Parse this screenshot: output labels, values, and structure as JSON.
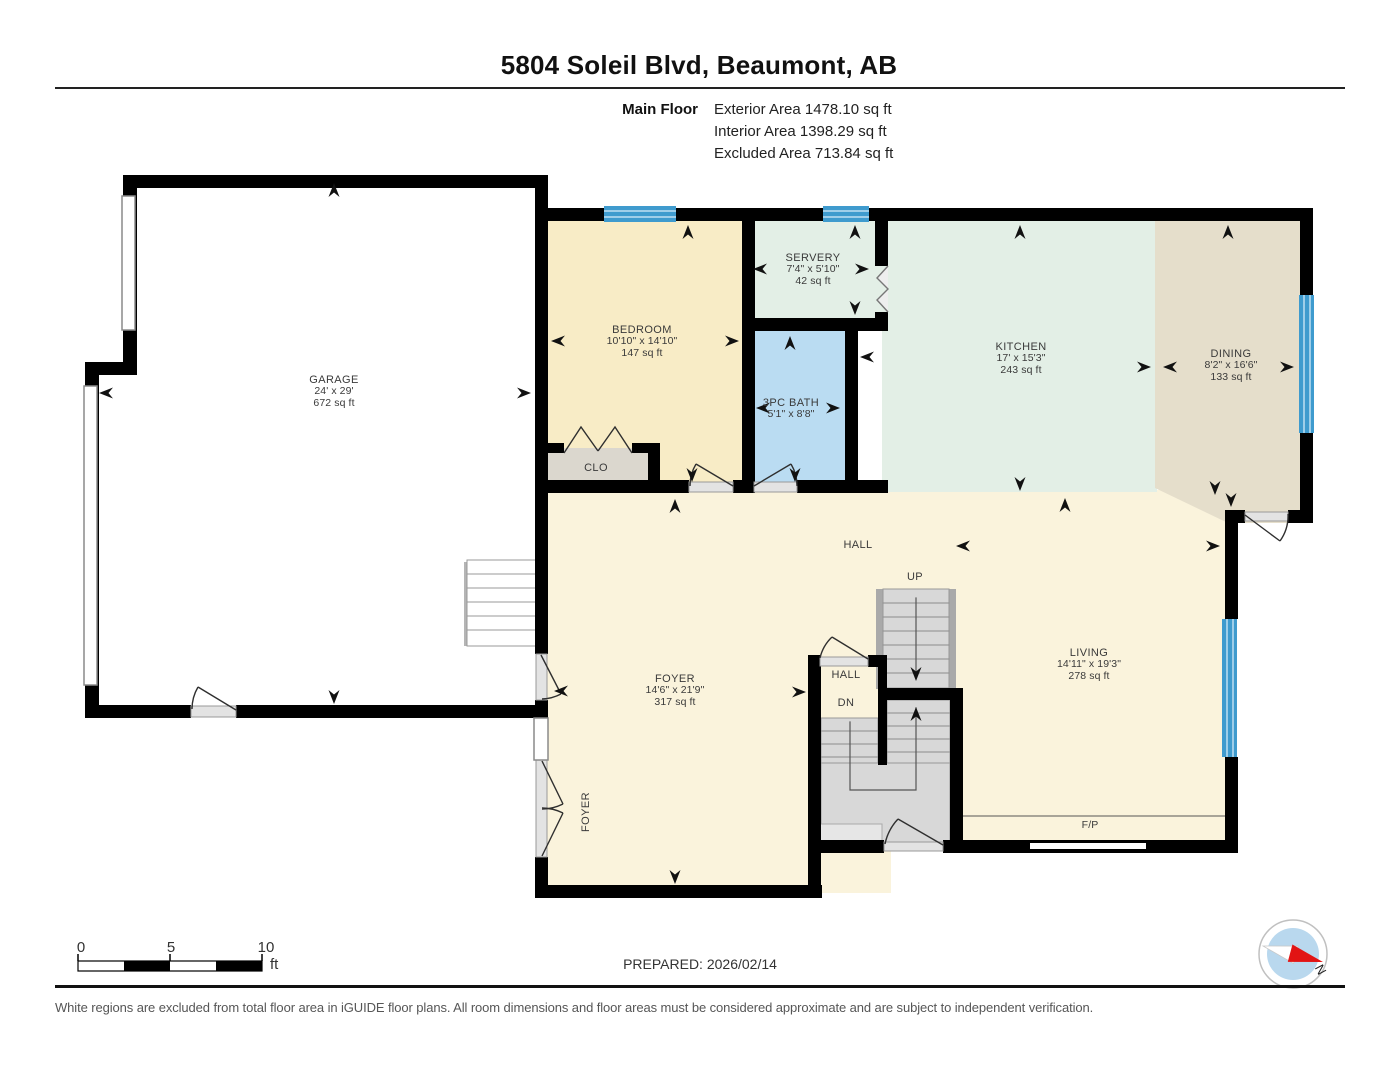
{
  "header": {
    "title": "5804 Soleil Blvd, Beaumont, AB",
    "floor_label": "Main Floor",
    "stats": [
      "Exterior Area 1478.10 sq ft",
      "Interior Area 1398.29 sq ft",
      "Excluded Area 713.84 sq ft"
    ]
  },
  "rooms": {
    "garage": {
      "name": "GARAGE",
      "dims": "24' x 29'",
      "area": "672 sq ft"
    },
    "bedroom": {
      "name": "BEDROOM",
      "dims": "10'10\" x 14'10\"",
      "area": "147 sq ft"
    },
    "servery": {
      "name": "SERVERY",
      "dims": "7'4\" x 5'10\"",
      "area": "42 sq ft"
    },
    "bath": {
      "name": "3PC BATH",
      "dims": "5'1\" x 8'8\""
    },
    "kitchen": {
      "name": "KITCHEN",
      "dims": "17' x 15'3\"",
      "area": "243 sq ft"
    },
    "dining": {
      "name": "DINING",
      "dims": "8'2\" x 16'6\"",
      "area": "133 sq ft"
    },
    "foyer": {
      "name": "FOYER",
      "dims": "14'6\" x 21'9\"",
      "area": "317 sq ft"
    },
    "living": {
      "name": "LIVING",
      "dims": "14'11\" x 19'3\"",
      "area": "278 sq ft"
    },
    "closet": {
      "name": "CLO"
    },
    "hall_main": {
      "name": "HALL"
    },
    "hall_stairs": {
      "name": "HALL"
    },
    "foyer_side": {
      "name": "FOYER"
    }
  },
  "stairs": {
    "up_label": "UP",
    "down_label": "DN"
  },
  "fireplace_label": "F/P",
  "scale_bar": {
    "ticks": [
      "0",
      "5",
      "10"
    ],
    "unit": "ft"
  },
  "footer": {
    "prepared": "PREPARED: 2026/02/14",
    "disclaimer": "White regions are excluded from total floor area in iGUIDE floor plans. All room dimensions and floor areas must be considered approximate and are subject to independent verification.",
    "compass_north": "N"
  },
  "colors": {
    "wall": "#000000",
    "window": "#3f9bce",
    "floor_hall_cream": "#faf3dc",
    "floor_bedroom": "#f8ecc6",
    "floor_kitchen_mint": "#e3efe6",
    "floor_dining_tan": "#e5decb",
    "floor_bath_blue": "#badcf2",
    "floor_closet_gray": "#dbd7ce",
    "stairs_gray": "#d8d8d8",
    "compass_blue": "#b9d8ee",
    "compass_red": "#e21414"
  }
}
